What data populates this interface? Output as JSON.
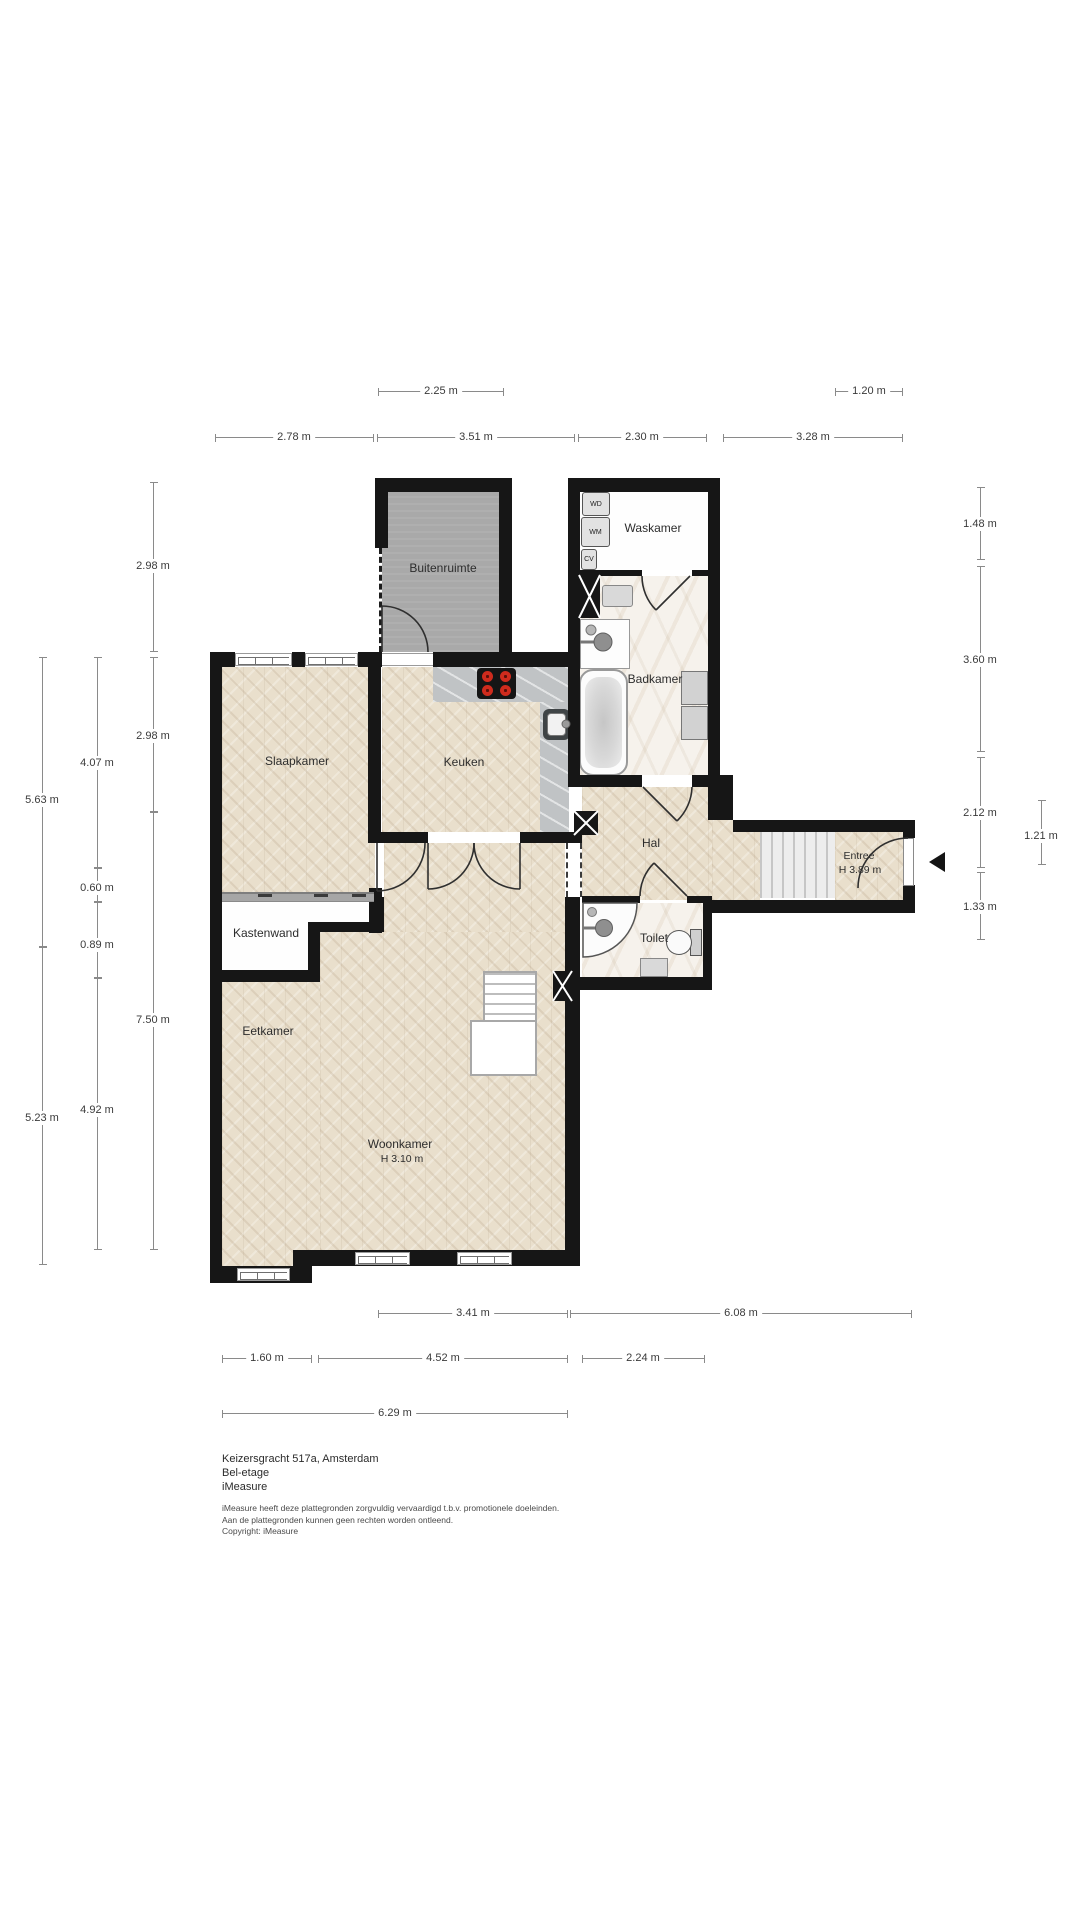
{
  "plan": {
    "address": "Keizersgracht 517a, Amsterdam",
    "floor_name": "Bel-etage",
    "brand": "iMeasure"
  },
  "footer": {
    "disclaimer": [
      "iMeasure heeft deze plattegronden zorgvuldig vervaardigd t.b.v. promotionele doeleinden.",
      "Aan de plattegronden kunnen geen rechten worden ontleend.",
      "Copyright: iMeasure"
    ]
  },
  "rooms": {
    "buitenruimte": {
      "label": "Buitenruimte"
    },
    "waskamer": {
      "label": "Waskamer"
    },
    "badkamer": {
      "label": "Badkamer"
    },
    "slaapkamer": {
      "label": "Slaapkamer"
    },
    "keuken": {
      "label": "Keuken"
    },
    "hal": {
      "label": "Hal"
    },
    "entree": {
      "label": "Entree",
      "height": "H 3.89 m"
    },
    "kastenwand": {
      "label": "Kastenwand"
    },
    "toilet": {
      "label": "Toilet"
    },
    "eetkamer": {
      "label": "Eetkamer"
    },
    "woonkamer": {
      "label": "Woonkamer",
      "height": "H 3.10 m"
    }
  },
  "appliances": {
    "wd": "WD",
    "wm": "WM",
    "cv": "CV"
  },
  "dims": {
    "top": [
      "2.25 m",
      "1.20 m",
      "2.78 m",
      "3.51 m",
      "2.30 m",
      "3.28 m"
    ],
    "bottom": [
      "3.41 m",
      "6.08 m",
      "1.60 m",
      "4.52 m",
      "2.24 m",
      "6.29 m"
    ],
    "left": [
      "2.98 m",
      "2.98 m",
      "7.50 m",
      "4.07 m",
      "0.60 m",
      "0.89 m",
      "4.92 m",
      "5.63 m",
      "5.23 m"
    ],
    "right": [
      "1.48 m",
      "3.60 m",
      "2.12 m",
      "1.33 m",
      "1.21 m"
    ]
  },
  "colors": {
    "wall": "#161616",
    "parquet": "#e9dfcc",
    "outdoor_gray": "#a9a9a9",
    "counter_gray": "#c0c3c5",
    "marble": "#f6f2ec",
    "burner_red": "#cf2b1d",
    "dim_line": "#8a8a8a"
  }
}
